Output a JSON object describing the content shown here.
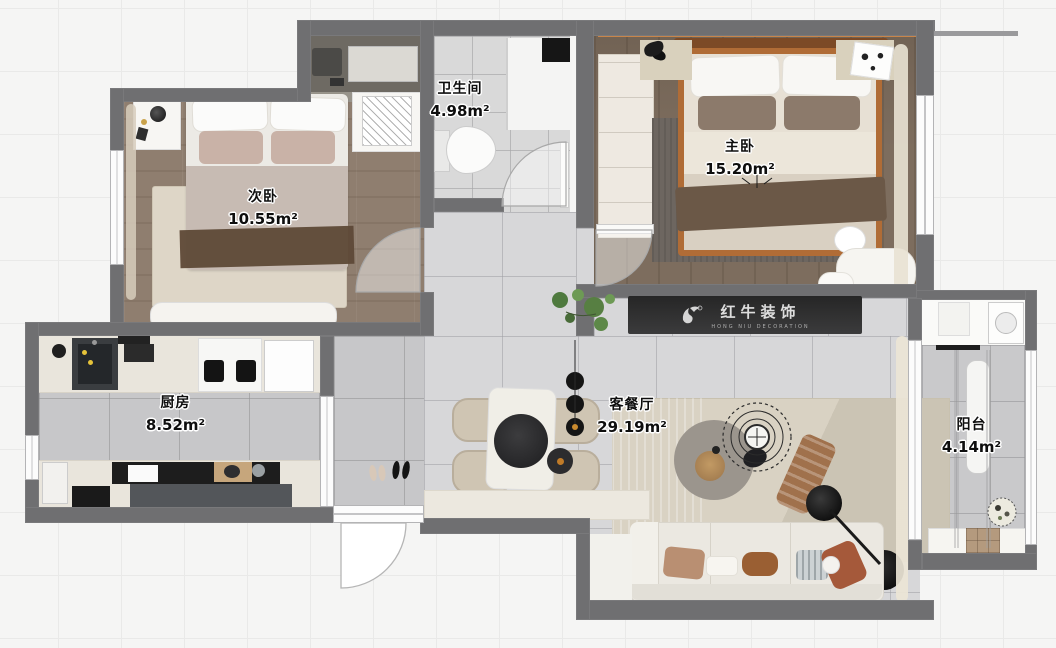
{
  "plan": {
    "type": "apartment-floor-plan",
    "view": "3d-rendered-top-down"
  },
  "rooms": [
    {
      "id": "bathroom",
      "name": "卫生间",
      "area": "4.98m²"
    },
    {
      "id": "master-bedroom",
      "name": "主卧",
      "area": "15.20m²"
    },
    {
      "id": "second-bedroom",
      "name": "次卧",
      "area": "10.55m²"
    },
    {
      "id": "kitchen",
      "name": "厨房",
      "area": "8.52m²"
    },
    {
      "id": "living-dining",
      "name": "客餐厅",
      "area": "29.19m²"
    },
    {
      "id": "balcony",
      "name": "阳台",
      "area": "4.14m²"
    }
  ],
  "watermark": {
    "brand": "红牛装饰",
    "subtitle": "HONG NIU DECORATION"
  },
  "colors": {
    "wall": "#6f6f71",
    "wood_light": "#8f7e6f",
    "wood_dark": "#7d6d5e",
    "tile_light": "#d7d7d9",
    "tile_mid": "#c7c7c9",
    "rug_beige": "#d9d2c3",
    "rug_gray": "#6d6660",
    "bed_frame_orange": "#b06c36",
    "headboard": "#7c4a26",
    "tv_console": "#2e2e2e",
    "counter_cream": "#e9e5dc"
  }
}
